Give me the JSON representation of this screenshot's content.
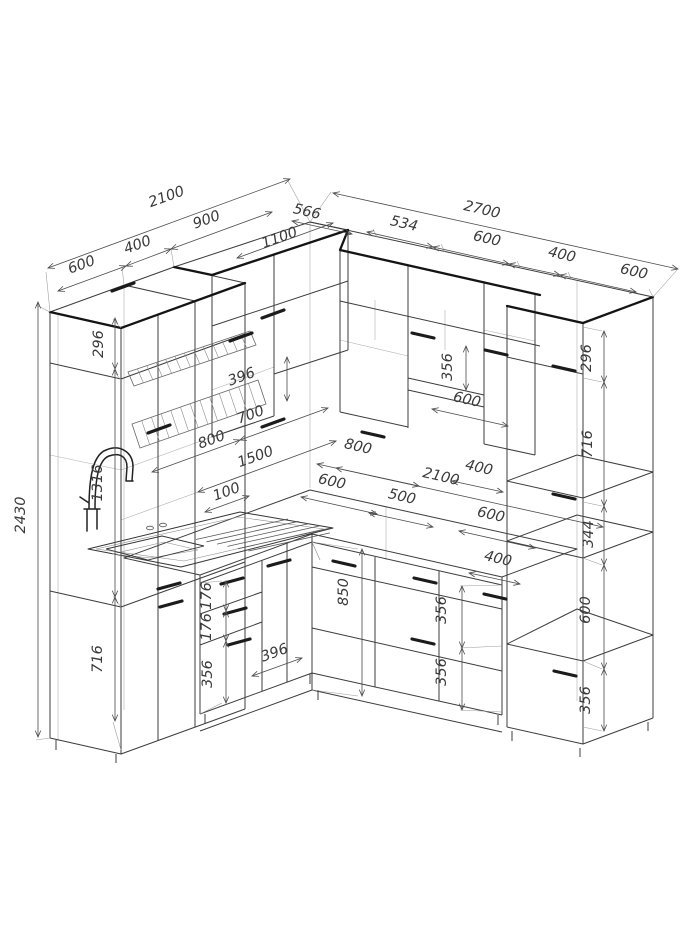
{
  "drawing": {
    "title": "kitchen-furniture-dimensional-drawing",
    "units_note": "",
    "accent_line_color": "#141414",
    "line_color": "#3c3c3c",
    "dim_color": "#3a3a3a"
  },
  "dims": {
    "left_run_total": "2100",
    "left_seg_600": "600",
    "left_seg_400": "400",
    "left_seg_900": "900",
    "corner_upper_1100": "1100",
    "corner_depth_566": "566",
    "right_run_total": "2700",
    "right_seg_534": "534",
    "right_seg_600_a": "600",
    "right_seg_400": "400",
    "right_seg_600_b": "600",
    "total_height_2430": "2430",
    "left_top_296": "296",
    "left_mid_1316": "1316",
    "left_bottom_716": "716",
    "upper_396": "396",
    "upper_700": "700",
    "upper_800_left": "800",
    "counter_1500": "1500",
    "splash_100": "100",
    "upper_800_right": "800",
    "hood_niche_356": "356",
    "hood_niche_600": "600",
    "counter_600_left": "600",
    "counter_2100": "2100",
    "counter_500": "500",
    "counter_600_right": "600",
    "upper_400": "400",
    "base_400": "400",
    "right_top_296": "296",
    "right_upper_716": "716",
    "right_niche_344": "344",
    "right_shelf_600": "600",
    "right_drawer_356": "356",
    "drawer_176_a": "176",
    "drawer_176_b": "176",
    "drawer_356_left": "356",
    "base_396": "396",
    "base_height_850": "850",
    "drawer_356_mid_a": "356",
    "drawer_356_mid_b": "356"
  }
}
